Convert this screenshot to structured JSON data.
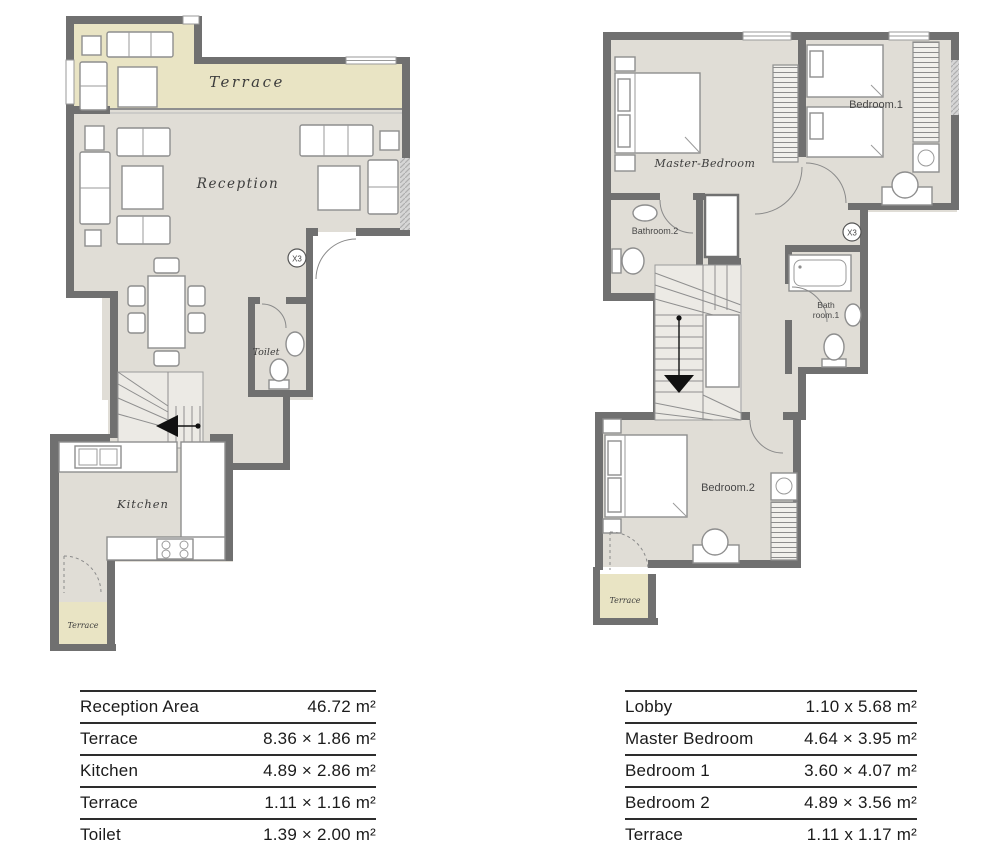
{
  "colors": {
    "wall": "#707070",
    "floor": "#e0ddd6",
    "terrace": "#e9e4c4",
    "window_hatch": "#c9c9c9",
    "table_line": "#2d2d2d",
    "table_text": "#1b1b1b"
  },
  "plans": {
    "left": {
      "labels": {
        "terrace_top": "Terrace",
        "reception": "Reception",
        "toilet": "Toilet",
        "kitchen": "Kitchen",
        "terrace_bottom": "Terrace",
        "unit_marker": "X3"
      }
    },
    "right": {
      "labels": {
        "master_bedroom": "Master-Bedroom",
        "bedroom1": "Bedroom.1",
        "bathroom2": "Bathroom.2",
        "bathroom1_line1": "Bath",
        "bathroom1_line2": "room.1",
        "bedroom2": "Bedroom.2",
        "terrace": "Terrace",
        "unit_marker": "X3"
      }
    }
  },
  "tables": {
    "left": {
      "rows": [
        {
          "label": "Reception Area",
          "value": "46.72 m²"
        },
        {
          "label": "Terrace",
          "value": "8.36 × 1.86 m²"
        },
        {
          "label": "Kitchen",
          "value": "4.89 × 2.86 m²"
        },
        {
          "label": "Terrace",
          "value": "1.11 × 1.16 m²"
        },
        {
          "label": "Toilet",
          "value": "1.39 × 2.00 m²"
        }
      ]
    },
    "right": {
      "rows": [
        {
          "label": "Lobby",
          "value": "1.10 x 5.68 m²"
        },
        {
          "label": "Master Bedroom",
          "value": "4.64 × 3.95 m²"
        },
        {
          "label": "Bedroom 1",
          "value": "3.60 × 4.07 m²"
        },
        {
          "label": "Bedroom 2",
          "value": "4.89 × 3.56 m²"
        },
        {
          "label": "Terrace",
          "value": "1.11 x 1.17 m²"
        }
      ]
    }
  }
}
